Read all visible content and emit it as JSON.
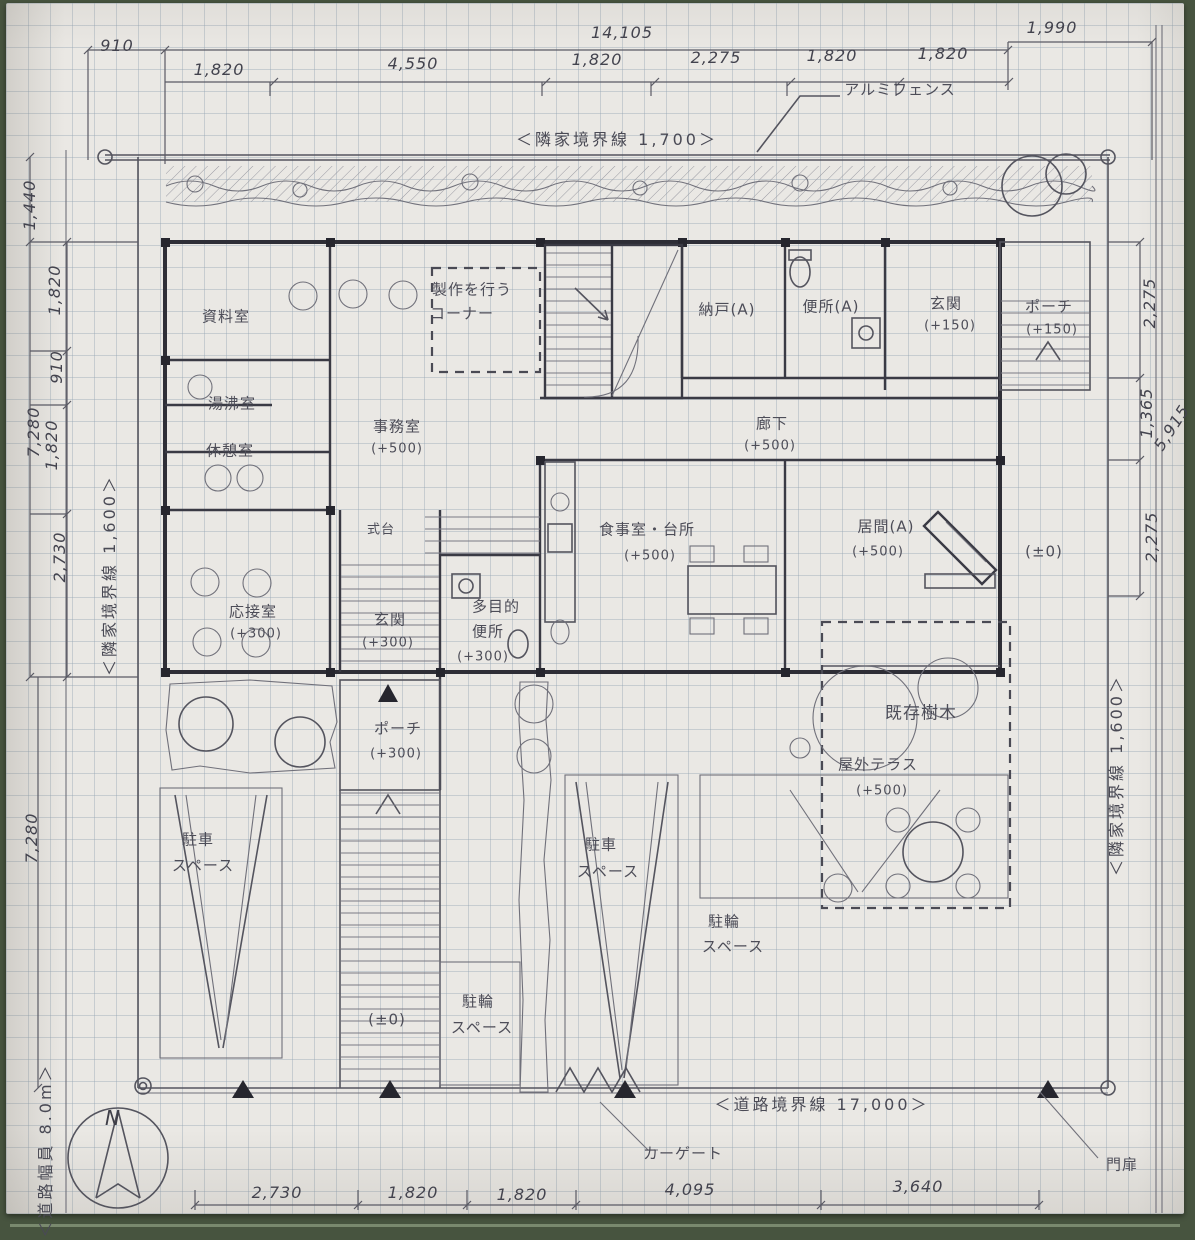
{
  "palette": {
    "paper": "#eae8e4",
    "board_green": "#47543f",
    "pencil": "#4d4d58",
    "ink": "#2e2e36"
  },
  "compass": {
    "north_label": "N"
  },
  "boundaries": {
    "neighbor_top": "＜隣家境界線 1,700＞",
    "neighbor_left": "＜隣家境界線 1,600＞",
    "neighbor_right": "＜隣家境界線 1,600＞",
    "road": "＜道路境界線 17,000＞",
    "road_width": "＜道路幅員 8.0m＞",
    "fence": "アルミフェンス",
    "car_gate": "カーゲート",
    "gate": "門扉"
  },
  "dims": {
    "top_overall": [
      "910",
      "14,105",
      "1,990"
    ],
    "top_segments": [
      "1,820",
      "4,550",
      "1,820",
      "2,275",
      "1,820",
      "1,820"
    ],
    "left": {
      "offset": "1,440",
      "upper_total": "7,280",
      "upper_segments": [
        "1,820",
        "910",
        "1,820",
        "2,730"
      ],
      "lower_total": "7,280"
    },
    "right": {
      "segments": [
        "2,275",
        "1,365",
        "2,275"
      ],
      "total": "5,915"
    },
    "bottom_segments": [
      "2,730",
      "1,820",
      "1,820",
      "4,095",
      "3,640"
    ]
  },
  "rooms": {
    "shiryo": {
      "name": "資料室"
    },
    "yuwakashi": {
      "name": "湯沸室"
    },
    "kyukei": {
      "name": "休憩室"
    },
    "jimu": {
      "name": "事務室",
      "level": "(+500)"
    },
    "seisaku": {
      "line1": "製作を行う",
      "line2": "コーナー"
    },
    "nando": {
      "name": "納戸(A)"
    },
    "benjoA": {
      "name": "便所(A)"
    },
    "genkanA": {
      "name": "玄関",
      "level": "(+150)"
    },
    "porchA": {
      "name": "ポーチ",
      "level": "(+150)"
    },
    "roka": {
      "name": "廊下",
      "level": "(+500)"
    },
    "shokudo": {
      "name": "食事室・台所",
      "level": "(+500)"
    },
    "ima": {
      "name": "居間(A)",
      "level": "(+500)"
    },
    "shikidai": {
      "name": "式台"
    },
    "osetsu": {
      "name": "応接室",
      "level": "(+300)"
    },
    "genkanB": {
      "name": "玄関",
      "level": "(+300)"
    },
    "tamokuteki": {
      "line1": "多目的",
      "line2": "便所",
      "level": "(+300)"
    },
    "porchB": {
      "name": "ポーチ",
      "level": "(+300)"
    }
  },
  "outdoor": {
    "trees": "既存樹木",
    "terrace": {
      "name": "屋外テラス",
      "level": "(+500)"
    },
    "parking": {
      "line1": "駐車",
      "line2": "スペース"
    },
    "bicycle": {
      "line1": "駐輪",
      "line2": "スペース"
    },
    "level_zero": "(±0)"
  }
}
